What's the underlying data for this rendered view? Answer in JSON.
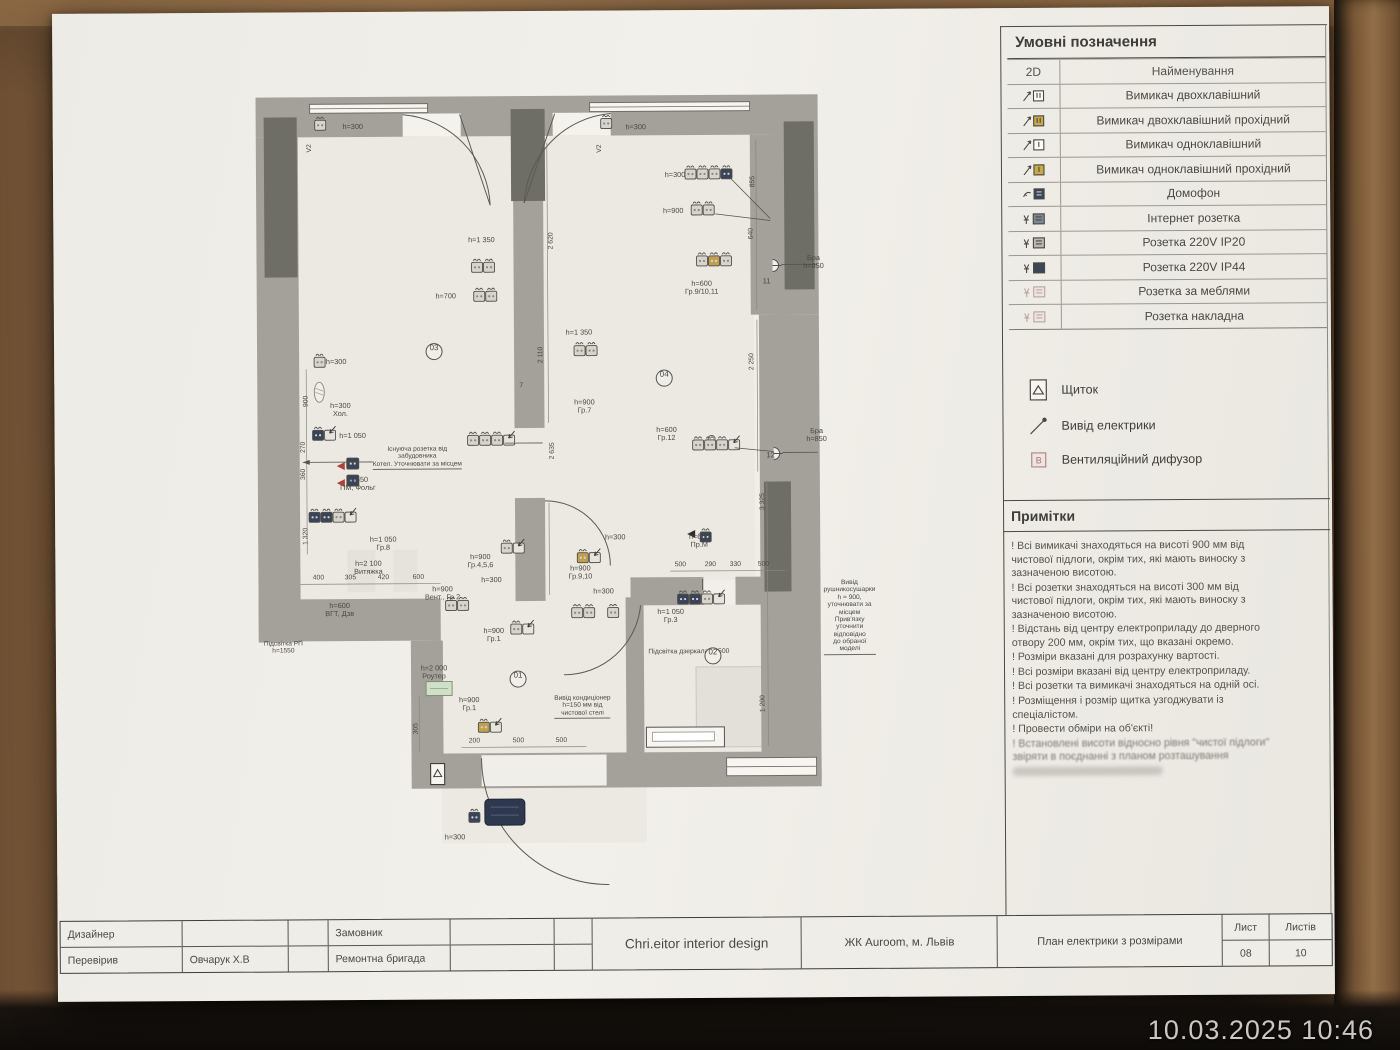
{
  "meta": {
    "timestamp": "10.03.2025 10:46"
  },
  "legend": {
    "title": "Умовні позначення",
    "col_2d": "2D",
    "col_name": "Найменування",
    "rows": [
      {
        "icon": "switch-double-icon",
        "label": "Вимикач двохклавішний"
      },
      {
        "icon": "switch-double-pass-icon",
        "label": "Вимикач двохклавішний прохідний"
      },
      {
        "icon": "switch-single-icon",
        "label": "Вимикач одноклавішний"
      },
      {
        "icon": "switch-single-pass-icon",
        "label": "Вимикач одноклавішний прохідний"
      },
      {
        "icon": "intercom-icon",
        "label": "Домофон"
      },
      {
        "icon": "internet-socket-icon",
        "label": "Інтернет розетка"
      },
      {
        "icon": "socket-ip20-icon",
        "label": "Розетка 220V IP20"
      },
      {
        "icon": "socket-ip44-icon",
        "label": "Розетка 220V IP44"
      },
      {
        "icon": "socket-furniture-icon",
        "label": "Розетка за меблями"
      },
      {
        "icon": "socket-surface-icon",
        "label": "Розетка накладна"
      }
    ],
    "extras": [
      {
        "icon": "shield-icon",
        "label": "Щиток"
      },
      {
        "icon": "power-outlet-icon",
        "label": "Вивід електрики"
      },
      {
        "icon": "vent-diffuser-icon",
        "label": "Вентиляційний дифузор"
      }
    ]
  },
  "notes": {
    "title": "Примітки",
    "items": [
      {
        "text": "! Всі вимикачі знаходяться на висоті 900 мм від чистової підлоги, окрім тих, які мають виноску з зазначеною висотою.",
        "smudged": false
      },
      {
        "text": "! Всі розетки знаходяться на висоті 300 мм від чистової підлоги, окрім тих, які мають виноску з зазначеною висотою.",
        "smudged": false
      },
      {
        "text": "! Відстань від центру електроприладу до дверного отвору 200 мм, окрім тих, що вказані окремо.",
        "smudged": false
      },
      {
        "text": "! Розміри вказані для розрахунку вартості.",
        "smudged": false
      },
      {
        "text": "! Всі розміри вказані від центру електроприладу.",
        "smudged": false
      },
      {
        "text": "! Всі розетки та вимикачі знаходяться на одній осі.",
        "smudged": false
      },
      {
        "text": "! Розміщення і розмір щитка узгоджувати із спеціалістом.",
        "smudged": false
      },
      {
        "text": "! Провести обміри на об'єкті!",
        "smudged": false
      },
      {
        "text": "! Встановлені висоти відносно рівня \"чистої підлоги\" звіряти в поєднанні з планом розташування",
        "smudged": true
      }
    ]
  },
  "titleblock": {
    "designer_label": "Дизайнер",
    "checked_label": "Перевірив",
    "checked_value": "Овчарук Х.В",
    "client_label": "Замовник",
    "client_value": "Ремонтна бригада",
    "studio": "Chri.eitor interior design",
    "project": "ЖК Auroom, м. Львів",
    "sheet_title": "План електрики з розмірами",
    "sheet_label": "Лист",
    "sheets_label": "Листів",
    "sheet_number": "08",
    "sheets_total": "10"
  },
  "plan": {
    "rooms": [
      "01",
      "02",
      "03",
      "04"
    ],
    "labels": [
      {
        "x": 100,
        "y": 43,
        "c": "pl-lbl",
        "t": "h=300"
      },
      {
        "x": 383,
        "y": 45,
        "c": "pl-lbl",
        "t": "h=300"
      },
      {
        "x": 57,
        "y": 64,
        "c": "pl-vdim",
        "t": "V2"
      },
      {
        "x": 347,
        "y": 66,
        "c": "pl-vdim",
        "t": "V2"
      },
      {
        "x": 422,
        "y": 93,
        "c": "pl-lbl",
        "t": "h=300"
      },
      {
        "x": 420,
        "y": 129,
        "c": "pl-lbl",
        "t": "h=900"
      },
      {
        "x": 448,
        "y": 206,
        "c": "pl-lbl",
        "t": "h=600\nГр.9/10,11"
      },
      {
        "x": 560,
        "y": 181,
        "c": "pl-lbl",
        "t": "Бра h=850"
      },
      {
        "x": 513,
        "y": 200,
        "c": "pl-red",
        "t": "11"
      },
      {
        "x": 228,
        "y": 157,
        "c": "pl-lbl",
        "t": "h=1 350"
      },
      {
        "x": 192,
        "y": 213,
        "c": "pl-lbl",
        "t": "h=700"
      },
      {
        "x": 325,
        "y": 250,
        "c": "pl-lbl",
        "t": "h=1 350"
      },
      {
        "x": 180,
        "y": 268,
        "c": "pl-room",
        "t": "03"
      },
      {
        "x": 410,
        "y": 296,
        "c": "pl-room",
        "t": "04"
      },
      {
        "x": 82,
        "y": 278,
        "c": "pl-lbl",
        "t": "h=300"
      },
      {
        "x": 86,
        "y": 326,
        "c": "pl-lbl",
        "t": "h=300\nХол."
      },
      {
        "x": 98,
        "y": 352,
        "c": "pl-lbl",
        "t": "h=1 050"
      },
      {
        "x": 118,
        "y": 362,
        "c": "pl-note u",
        "t": "Існуюча розетка від\nзабудовника\nКотел. Уточнювати за місцем"
      },
      {
        "x": 330,
        "y": 324,
        "c": "pl-lbl",
        "t": "h=900\nГр.7"
      },
      {
        "x": 267,
        "y": 303,
        "c": "pl-dim",
        "t": "7"
      },
      {
        "x": 412,
        "y": 352,
        "c": "pl-lbl",
        "t": "h=600\nГр.12"
      },
      {
        "x": 562,
        "y": 354,
        "c": "pl-lbl",
        "t": "Бра h=850"
      },
      {
        "x": 516,
        "y": 374,
        "c": "pl-red",
        "t": "12"
      },
      {
        "x": 103,
        "y": 400,
        "c": "pl-lbl",
        "t": "h=650\nПМ, Фольг"
      },
      {
        "x": 128,
        "y": 460,
        "c": "pl-lbl",
        "t": "h=1 050\nГр.8"
      },
      {
        "x": 113,
        "y": 484,
        "c": "pl-lbl",
        "t": "h=2 100\nВитяжка"
      },
      {
        "x": 225,
        "y": 478,
        "c": "pl-lbl",
        "t": "h=900\nГр.4,5,6"
      },
      {
        "x": 236,
        "y": 497,
        "c": "pl-lbl",
        "t": "h=300"
      },
      {
        "x": 187,
        "y": 510,
        "c": "pl-lbl",
        "t": "h=900\nВент., Гр 2"
      },
      {
        "x": 325,
        "y": 490,
        "c": "pl-lbl",
        "t": "h=900\nГр.9,10"
      },
      {
        "x": 348,
        "y": 509,
        "c": "pl-lbl",
        "t": "h=300"
      },
      {
        "x": 360,
        "y": 455,
        "c": "pl-lbl",
        "t": "h=300"
      },
      {
        "x": 444,
        "y": 459,
        "c": "pl-lbl",
        "t": "h=650\nПр.М"
      },
      {
        "x": 415,
        "y": 534,
        "c": "pl-lbl",
        "t": "h=1 050\nГр.3"
      },
      {
        "x": 433,
        "y": 570,
        "c": "pl-dim",
        "t": "Підсвітка дзеркала h=500"
      },
      {
        "x": 457,
        "y": 574,
        "c": "pl-room",
        "t": "02"
      },
      {
        "x": 238,
        "y": 552,
        "c": "pl-lbl",
        "t": "h=900\nГр.1"
      },
      {
        "x": 262,
        "y": 596,
        "c": "pl-room",
        "t": "01"
      },
      {
        "x": 213,
        "y": 621,
        "c": "pl-lbl",
        "t": "h=900\nГр.1"
      },
      {
        "x": 298,
        "y": 612,
        "c": "pl-note u",
        "t": "Вивід кондиціонер\nh=150 мм від\nчистової стелі"
      },
      {
        "x": 568,
        "y": 498,
        "c": "pl-note u",
        "t": "Вивід рушникосушарки\nh = 900, уточнювати за місцем\nПрив'язку уточнити відповідно\nдо обраної моделі"
      },
      {
        "x": 178,
        "y": 589,
        "c": "pl-lbl",
        "t": "h=2 000\nРоутер"
      },
      {
        "x": 8,
        "y": 556,
        "c": "pl-note",
        "t": "Підсвітка РП\nh=1550"
      },
      {
        "x": 84,
        "y": 526,
        "c": "pl-lbl",
        "t": "h=600\nВГТ, Дзв"
      },
      {
        "x": 198,
        "y": 754,
        "c": "pl-lbl",
        "t": "h=300"
      },
      {
        "x": 63,
        "y": 494,
        "c": "pl-dim",
        "t": "400"
      },
      {
        "x": 95,
        "y": 494,
        "c": "pl-dim",
        "t": "305"
      },
      {
        "x": 128,
        "y": 494,
        "c": "pl-dim",
        "t": "420"
      },
      {
        "x": 163,
        "y": 494,
        "c": "pl-dim",
        "t": "600"
      },
      {
        "x": 425,
        "y": 483,
        "c": "pl-dim",
        "t": "500"
      },
      {
        "x": 455,
        "y": 483,
        "c": "pl-dim",
        "t": "290"
      },
      {
        "x": 480,
        "y": 483,
        "c": "pl-dim",
        "t": "330"
      },
      {
        "x": 508,
        "y": 483,
        "c": "pl-dim",
        "t": "500"
      },
      {
        "x": 218,
        "y": 658,
        "c": "pl-dim",
        "t": "200"
      },
      {
        "x": 262,
        "y": 658,
        "c": "pl-dim",
        "t": "500"
      },
      {
        "x": 305,
        "y": 658,
        "c": "pl-dim",
        "t": "500"
      },
      {
        "x": 287,
        "y": 272,
        "c": "pl-vdim",
        "t": "2 110"
      },
      {
        "x": 298,
        "y": 158,
        "c": "pl-vdim",
        "t": "2 620"
      },
      {
        "x": 298,
        "y": 368,
        "c": "pl-vdim",
        "t": "2 635"
      },
      {
        "x": 500,
        "y": 100,
        "c": "pl-vdim",
        "t": "855"
      },
      {
        "x": 498,
        "y": 152,
        "c": "pl-vdim",
        "t": "640"
      },
      {
        "x": 498,
        "y": 280,
        "c": "pl-vdim",
        "t": "2 250"
      },
      {
        "x": 508,
        "y": 420,
        "c": "pl-vdim",
        "t": "3 325"
      },
      {
        "x": 507,
        "y": 622,
        "c": "pl-vdim",
        "t": "1 200"
      },
      {
        "x": 52,
        "y": 317,
        "c": "pl-vdim",
        "t": "900"
      },
      {
        "x": 49,
        "y": 363,
        "c": "pl-vdim",
        "t": "270"
      },
      {
        "x": 49,
        "y": 390,
        "c": "pl-vdim",
        "t": "360"
      },
      {
        "x": 51,
        "y": 452,
        "c": "pl-vdim",
        "t": "1 320"
      },
      {
        "x": 160,
        "y": 645,
        "c": "pl-vdim",
        "t": "305"
      }
    ],
    "symbols": [
      {
        "t": "sock",
        "x": 62,
        "y": 36,
        "m": [
          "l"
        ]
      },
      {
        "t": "sock",
        "x": 348,
        "y": 36,
        "m": [
          "l"
        ]
      },
      {
        "t": "sock",
        "x": 432,
        "y": 87,
        "m": [
          "l",
          "l",
          "l",
          "d"
        ]
      },
      {
        "t": "sock",
        "x": 438,
        "y": 123,
        "m": [
          "l",
          "l"
        ]
      },
      {
        "t": "sock",
        "x": 443,
        "y": 174,
        "m": [
          "l",
          "t",
          "l"
        ]
      },
      {
        "t": "sconce",
        "x": 519,
        "y": 178
      },
      {
        "t": "sock",
        "x": 218,
        "y": 179,
        "m": [
          "l",
          "l"
        ]
      },
      {
        "t": "sock",
        "x": 220,
        "y": 208,
        "m": [
          "l",
          "l"
        ]
      },
      {
        "t": "sock",
        "x": 320,
        "y": 263,
        "m": [
          "l",
          "l"
        ]
      },
      {
        "t": "sock",
        "x": 60,
        "y": 273,
        "m": [
          "l"
        ]
      },
      {
        "t": "lamp",
        "x": 65,
        "y": 308
      },
      {
        "t": "sock",
        "x": 58,
        "y": 346,
        "m": [
          "d"
        ],
        "sw": 1
      },
      {
        "t": "sock",
        "x": 213,
        "y": 352,
        "m": [
          "l",
          "l",
          "l"
        ],
        "sw": 1
      },
      {
        "t": "node",
        "x": 457,
        "y": 357
      },
      {
        "t": "sock",
        "x": 438,
        "y": 358,
        "m": [
          "l",
          "l",
          "l"
        ],
        "sw": 1
      },
      {
        "t": "sconce",
        "x": 519,
        "y": 366
      },
      {
        "t": "pmf",
        "x": 92,
        "y": 374
      },
      {
        "t": "sock",
        "x": 54,
        "y": 428,
        "m": [
          "d",
          "d",
          "l"
        ],
        "sw": 1
      },
      {
        "t": "sock",
        "x": 246,
        "y": 460,
        "m": [
          "l"
        ],
        "sw": 1
      },
      {
        "t": "sock",
        "x": 190,
        "y": 517,
        "m": [
          "l",
          "l"
        ]
      },
      {
        "t": "sock",
        "x": 316,
        "y": 525,
        "m": [
          "l",
          "l"
        ]
      },
      {
        "t": "sock",
        "x": 352,
        "y": 525,
        "m": [
          "l"
        ]
      },
      {
        "t": "sock",
        "x": 322,
        "y": 470,
        "m": [
          "t"
        ],
        "sw": 1
      },
      {
        "t": "tri",
        "x": 432,
        "y": 452
      },
      {
        "t": "sock",
        "x": 445,
        "y": 450,
        "m": [
          "d"
        ]
      },
      {
        "t": "sock",
        "x": 422,
        "y": 512,
        "m": [
          "d",
          "d",
          "l"
        ],
        "sw": 1
      },
      {
        "t": "sock",
        "x": 255,
        "y": 541,
        "m": [
          "l"
        ],
        "sw": 1
      },
      {
        "t": "router",
        "x": 170,
        "y": 598
      },
      {
        "t": "sock",
        "x": 222,
        "y": 639,
        "m": [
          "t"
        ],
        "sw": 1
      },
      {
        "t": "shield",
        "x": 174,
        "y": 680
      },
      {
        "t": "sock",
        "x": 212,
        "y": 729,
        "m": [
          "d"
        ]
      },
      {
        "t": "mat",
        "x": 228,
        "y": 716
      },
      {
        "t": "wire",
        "p": [
          [
            478,
            97
          ],
          [
            517,
            137
          ]
        ]
      },
      {
        "t": "wire",
        "p": [
          [
            462,
            132
          ],
          [
            517,
            139
          ]
        ]
      },
      {
        "t": "wire",
        "p": [
          [
            480,
            366
          ],
          [
            519,
            370
          ]
        ]
      },
      {
        "t": "wire",
        "p": [
          [
            528,
            183
          ],
          [
            563,
            183
          ]
        ]
      },
      {
        "t": "wire",
        "p": [
          [
            528,
            371
          ],
          [
            563,
            371
          ]
        ]
      },
      {
        "t": "arrowline",
        "p": [
          [
            118,
            378
          ],
          [
            48,
            378
          ]
        ]
      },
      {
        "t": "wire",
        "p": [
          [
            250,
            360
          ],
          [
            288,
            360
          ]
        ]
      },
      {
        "t": "wire",
        "p": [
          [
            447,
            508
          ],
          [
            447,
            497
          ]
        ]
      }
    ]
  }
}
